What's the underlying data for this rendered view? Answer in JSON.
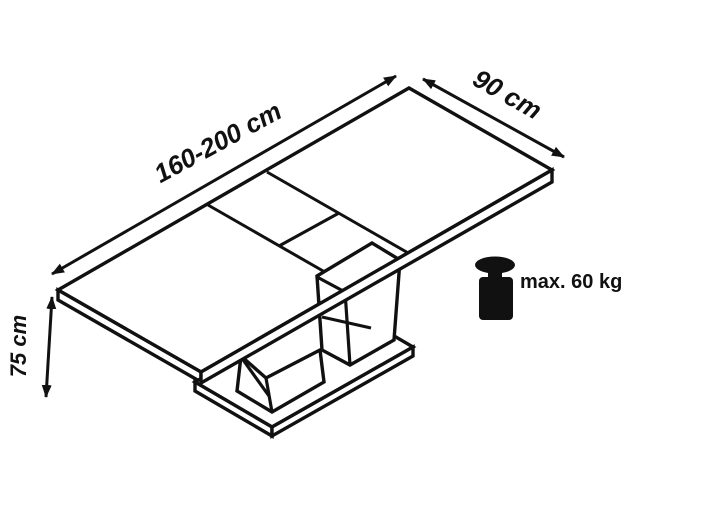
{
  "diagram": {
    "type": "furniture-dimension-diagram",
    "subject": "extendable-pedestal-table",
    "labels": {
      "length": "160-200 cm",
      "width": "90 cm",
      "height": "75 cm",
      "max_load": "max. 60 kg"
    },
    "icons": {
      "weight": "weight-icon"
    },
    "colors": {
      "line": "#111111",
      "background": "#ffffff"
    }
  }
}
